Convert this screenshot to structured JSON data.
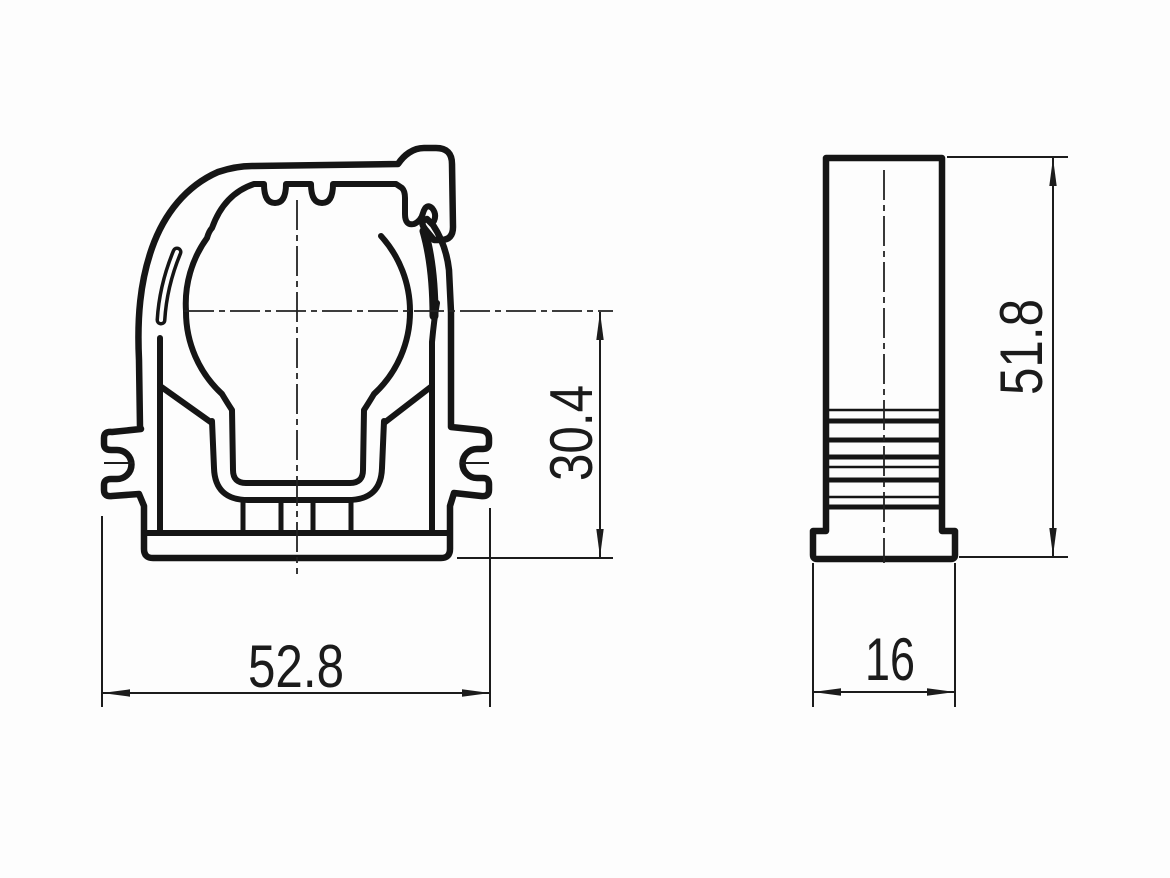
{
  "drawing": {
    "type": "two-view technical drawing of a pipe clamp profile",
    "background": "#fdfdfd",
    "line_color": "#151515",
    "front_view": {
      "label": "front-view",
      "width_dim": "52.8",
      "seat_height_dim": "30.4"
    },
    "side_view": {
      "label": "side-view",
      "height_dim": "51.8",
      "depth_dim": "16"
    }
  }
}
